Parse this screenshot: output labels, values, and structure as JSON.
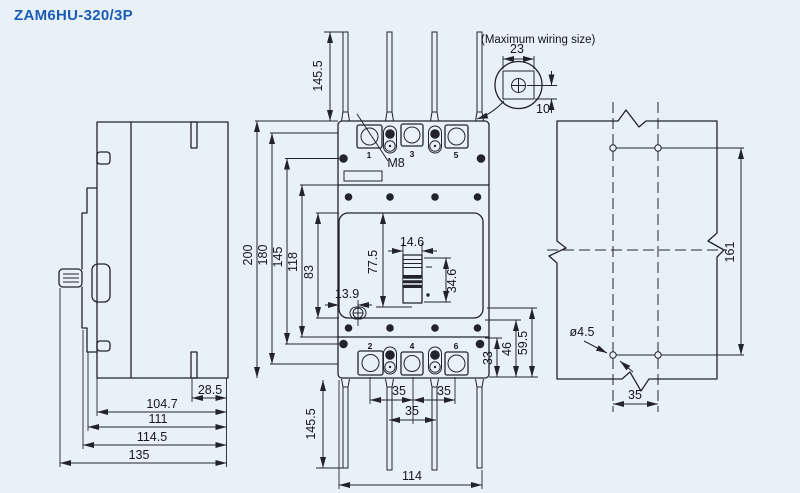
{
  "title": "ZAM6HU-320/3P",
  "colors": {
    "background": "#e9f1f8",
    "line": "#23232e",
    "title_blue": "#1a5cb5"
  },
  "wiring_detail": {
    "note": "(Maximum wiring size)",
    "width": "23",
    "depth": "10"
  },
  "side_view": {
    "slot": "28.5",
    "body_depth": "104.7",
    "depth_mid": "111",
    "depth_front": "114.5",
    "depth_overall": "135"
  },
  "front_view": {
    "pole_top": [
      "1",
      "3",
      "5"
    ],
    "pole_bottom": [
      "2",
      "4",
      "6"
    ],
    "screw": "M8",
    "bar_top": "145.5",
    "bar_bottom": "145.5",
    "h200": "200",
    "h180": "180",
    "h145": "145",
    "h118": "118",
    "h83": "83",
    "handle_window": "77.5",
    "handle_w": "14.6",
    "handle_h": "34.6",
    "btn_offset": "13.9",
    "r33": "33",
    "r46": "46",
    "r59": "59.5",
    "pitch_a": "35",
    "pitch_b": "35",
    "pitch_c": "35",
    "bottom_w": "114"
  },
  "drill_view": {
    "span": "161",
    "dia": "ø4.5",
    "pitch": "35"
  }
}
